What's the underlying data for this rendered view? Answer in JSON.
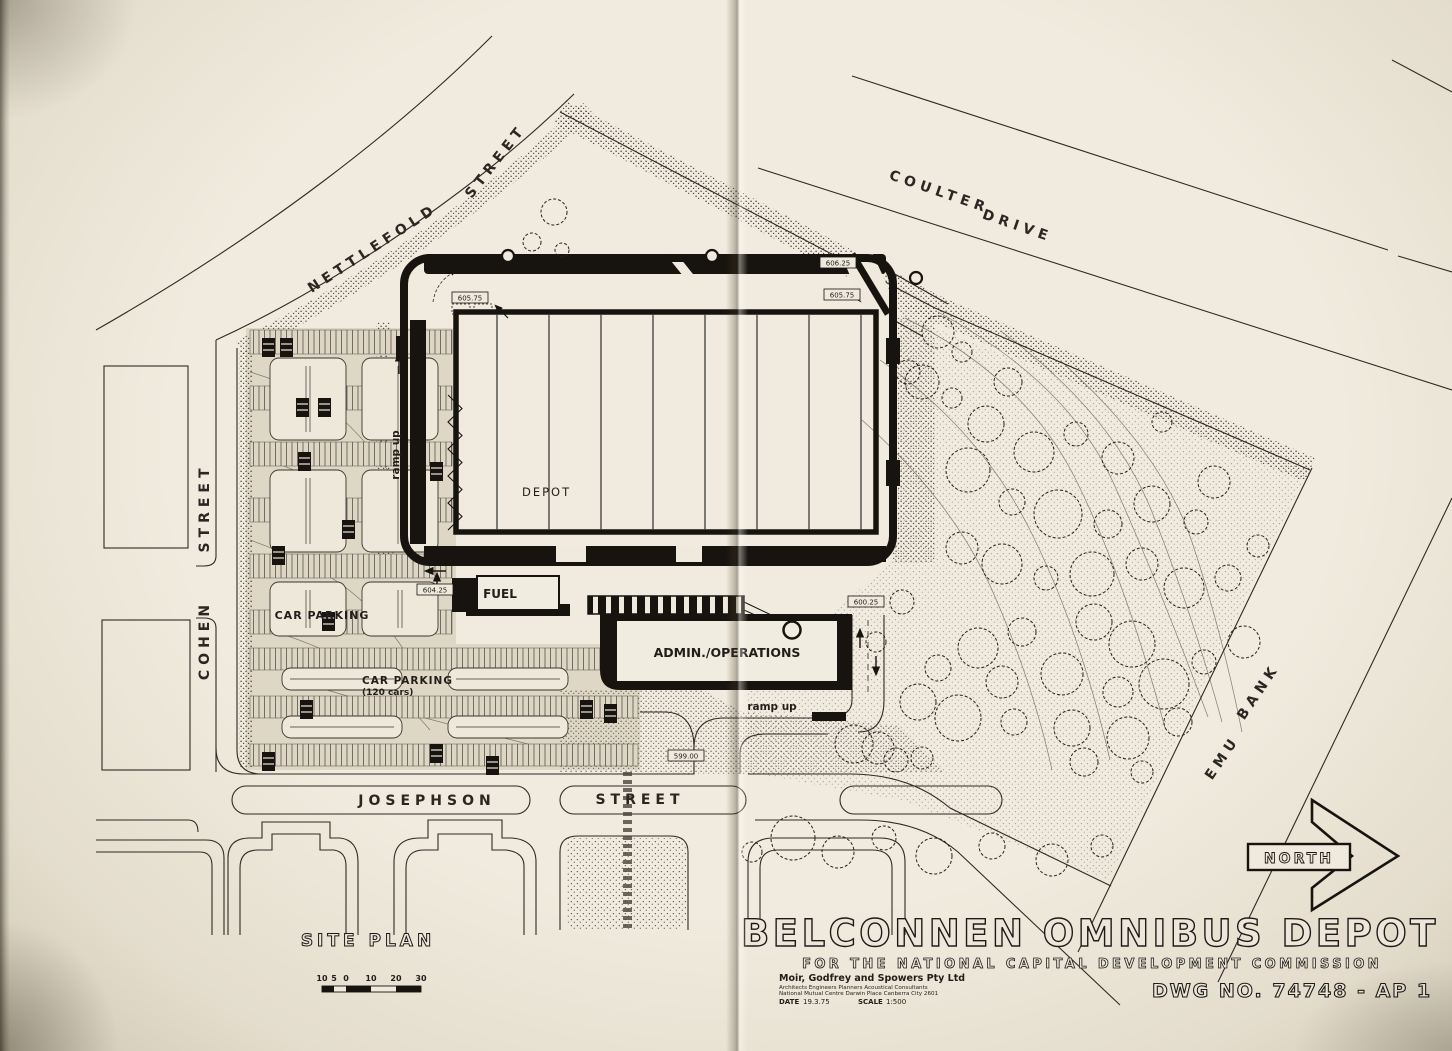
{
  "page": {
    "paper_color": "#ece7db",
    "ink_color": "#1d1b18"
  },
  "streets": {
    "nettlefold": {
      "name": "NETTLEFOLD",
      "suffix": "STREET"
    },
    "coulter": {
      "name": "COULTER",
      "suffix": "DRIVE"
    },
    "cohen": {
      "name": "COHEN",
      "suffix": "STREET"
    },
    "josephson": {
      "name": "JOSEPHSON",
      "suffix": "STREET"
    },
    "emu": {
      "name": "EMU",
      "suffix": "BANK"
    }
  },
  "site": {
    "depot_label": "DEPOT",
    "fuel_label": "FUEL",
    "admin_label": "ADMIN./OPERATIONS",
    "car_parking_west": "CAR PARKING",
    "car_parking_south": "CAR PARKING",
    "car_parking_south_capacity": "(120 cars)",
    "ramp_up_west": "ramp up",
    "ramp_up_south": "ramp up",
    "levels": {
      "nw": "605.75",
      "ne_upper": "606.25",
      "ne": "605.75",
      "fuel": "604.25",
      "ramp_east": "600.25",
      "south_entry": "599.00"
    }
  },
  "title_block": {
    "plan_label": "SITE PLAN",
    "title": "BELCONNEN OMNIBUS DEPOT",
    "subtitle": "FOR THE NATIONAL CAPITAL DEVELOPMENT COMMISSION",
    "firm_name": "Moir, Godfrey and Spowers Pty Ltd",
    "firm_disciplines": "Architects   Engineers   Planners   Acoustical Consultants",
    "firm_address": "National Mutual Centre   Darwin Place   Canberra City 2601",
    "date_label": "DATE",
    "date_value": "19.3.75",
    "scale_label": "SCALE",
    "scale_value": "1:500",
    "dwg_no": "DWG NO. 74748 - AP 1"
  },
  "north_arrow": {
    "label": "NORTH"
  },
  "scale_bar": {
    "ticks": [
      "10",
      "5",
      "0",
      "10",
      "20",
      "30"
    ]
  }
}
